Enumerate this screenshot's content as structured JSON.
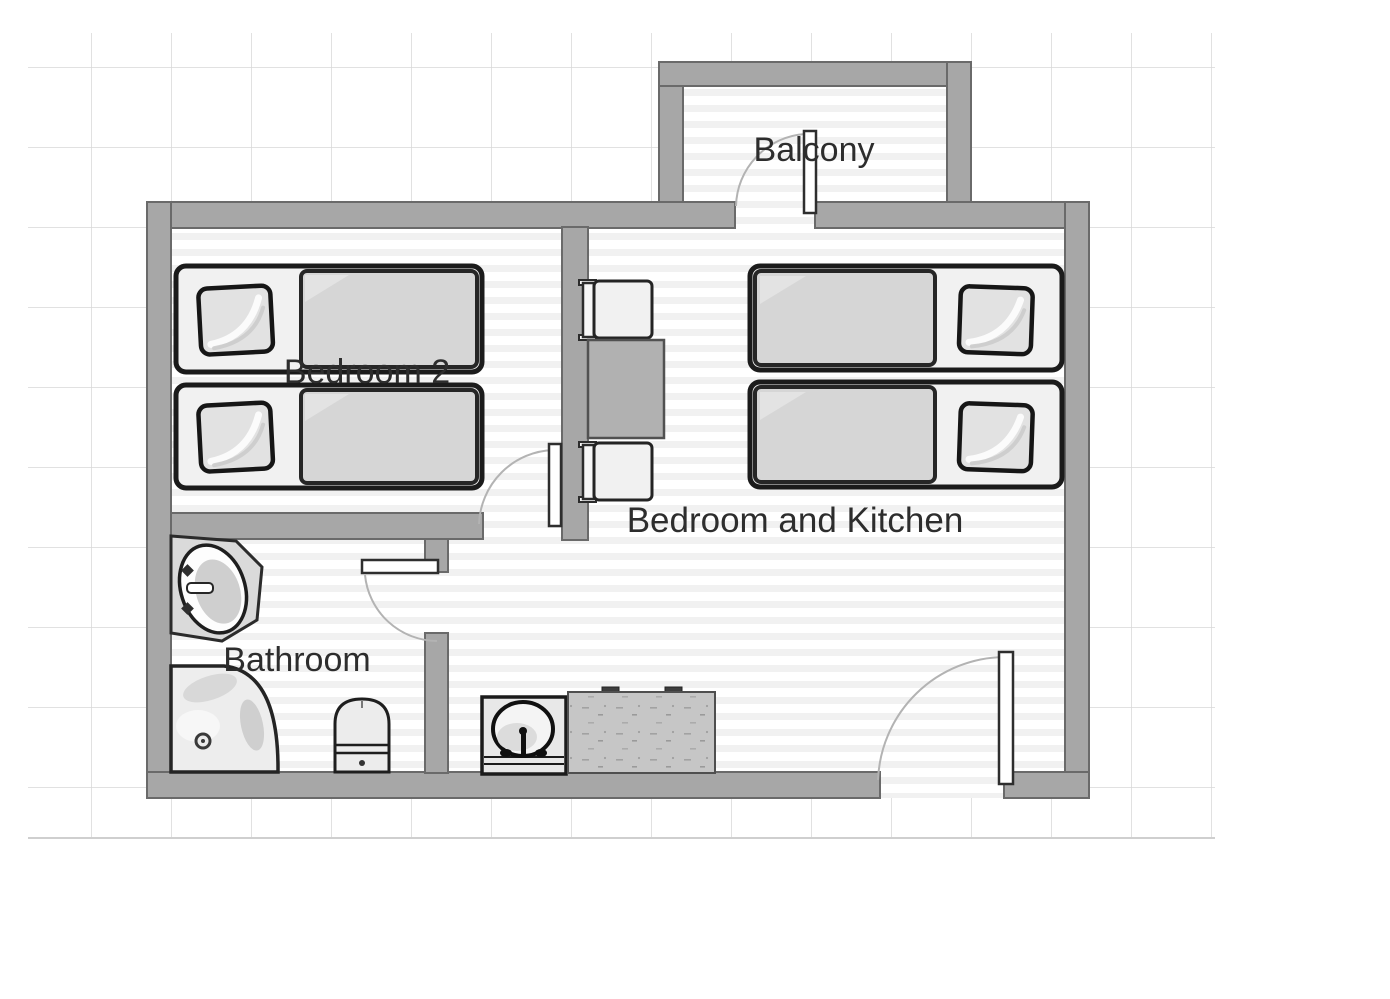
{
  "diagram_type": "apartment-floor-plan",
  "rooms": {
    "balcony": {
      "label": "Balcony"
    },
    "bedroom2": {
      "label": "Bedroom 2"
    },
    "bedroom_kitchen": {
      "label": "Bedroom and Kitchen"
    },
    "bathroom": {
      "label": "Bathroom"
    }
  },
  "furniture": {
    "bedroom2": [
      "single-bed",
      "single-bed"
    ],
    "bedroom_kitchen": [
      "single-bed",
      "single-bed",
      "dining-table",
      "chair",
      "chair",
      "kitchen-sink",
      "stove-counter"
    ],
    "bathroom": [
      "washbasin",
      "corner-bathtub",
      "toilet"
    ]
  },
  "doors": [
    "balcony-door",
    "bedroom2-door",
    "bathroom-door",
    "entrance-door"
  ],
  "colors": {
    "wall": "#a7a7a7",
    "wall_outline": "#6a6a6a",
    "floor_stripe": "#f1f1f1",
    "grid_line": "#d7d7d7",
    "furniture_fill": "#d6d6d6",
    "furniture_outline": "#1b1b1b",
    "table_fill": "#b1b1b1",
    "counter_fill": "#c6c6c6",
    "text": "#2d2d2d"
  }
}
